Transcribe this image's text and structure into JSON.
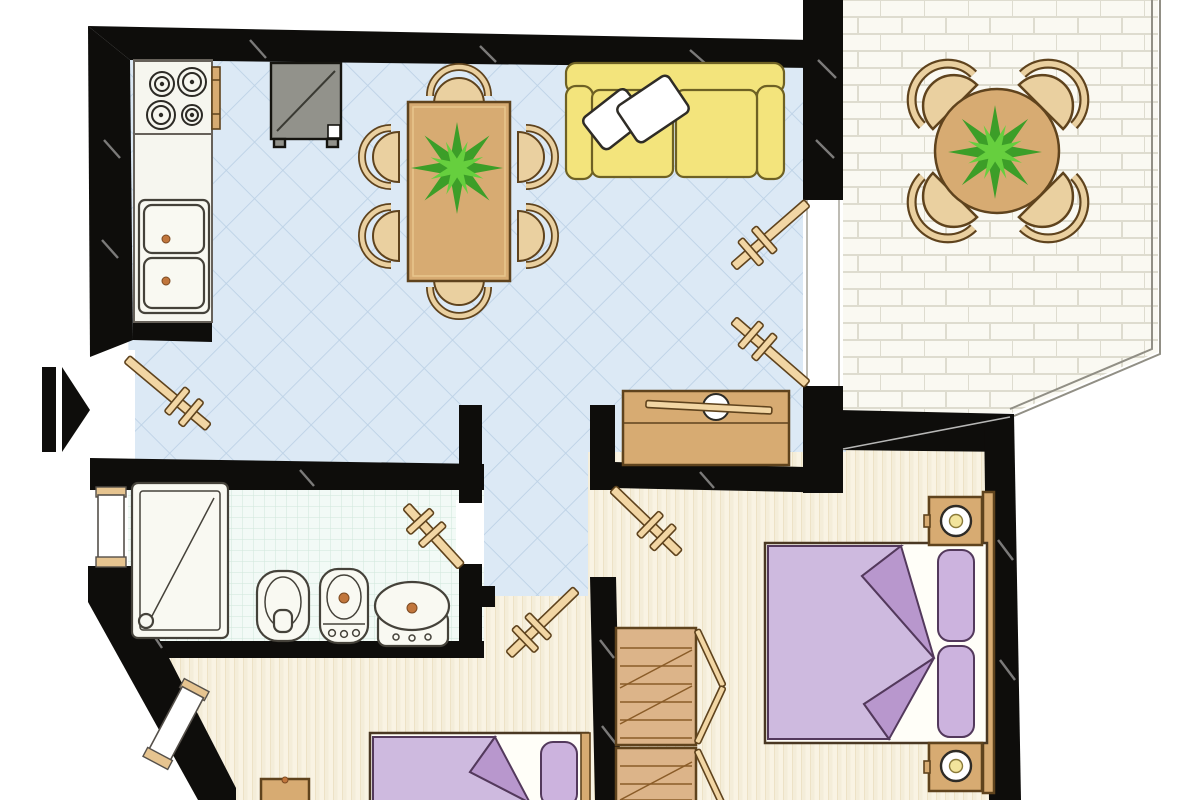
{
  "meta": {
    "title": "apartment-floor-plan",
    "canvas_width": 1200,
    "canvas_height": 800,
    "visible_text": "none"
  },
  "colors": {
    "wall": "#0e0d0b",
    "living_floor": "#dce9f5",
    "tile_line": "#bdd2e6",
    "bath_floor": "#f2faf6",
    "bath_grid": "#cfe7da",
    "wood_floor": "#f9f3e3",
    "wood_stripe": "#eadebe",
    "wood_shade": "#f4edd9",
    "balcony_floor": "#faf9f2",
    "brick_line": "#dedccf",
    "door_wood": "#f2d6a4",
    "wood_furniture": "#ead0a0",
    "wood_dark": "#d7ab72",
    "wood_border": "#5f431d",
    "sofa": "#f3e47c",
    "sofa_border": "#6e6124",
    "pillow_white": "#ffffff",
    "bed_blanket": "#cebadf",
    "bed_fold": "#b897cd",
    "bed_purple_border": "#53395c",
    "bed_pillow": "#ccb3de",
    "plant_dark": "#3c9e28",
    "plant_light": "#66cf3e",
    "appliance": "#92928b",
    "fixture": "#f9f9f2",
    "fixture_border": "#45423a",
    "accent_dot": "#c1763c",
    "arrow": "#0e0d0b",
    "lamp_core": "#f2e49c"
  },
  "rooms": [
    {
      "id": "living-dining",
      "floor": "blue-diagonal-tile",
      "furniture": [
        "dining-table",
        "plant",
        "six-chairs",
        "sofa",
        "two-white-cushions",
        "sideboard"
      ]
    },
    {
      "id": "kitchen",
      "floor": "blue-diagonal-tile",
      "furniture": [
        "stove-four-burners",
        "oven-handle",
        "counter",
        "double-sink",
        "appliance"
      ]
    },
    {
      "id": "balcony",
      "floor": "white-brick-paving",
      "furniture": [
        "round-table",
        "plant",
        "four-chairs"
      ]
    },
    {
      "id": "bathroom",
      "floor": "mint-grid-tile",
      "furniture": [
        "shower",
        "toilet",
        "bidet",
        "washbasin"
      ]
    },
    {
      "id": "hallway",
      "floor": "blue-diagonal-tile",
      "furniture": []
    },
    {
      "id": "bedroom-main",
      "floor": "wood-plank",
      "furniture": [
        "double-bed",
        "two-pillows",
        "headboard",
        "two-nightstands",
        "two-lamps",
        "wardrobe"
      ]
    },
    {
      "id": "bedroom-second",
      "floor": "wood-plank",
      "furniture": [
        "bed",
        "pillow",
        "headboard",
        "nightstand"
      ]
    }
  ],
  "doors": [
    {
      "id": "entry-door",
      "swing": "inward"
    },
    {
      "id": "bathroom-door",
      "swing": "into-bathroom"
    },
    {
      "id": "bedroom-main-door",
      "swing": "into-bedroom"
    },
    {
      "id": "bedroom-second-door",
      "swing": "into-bedroom"
    },
    {
      "id": "balcony-double-door-upper-leaf",
      "swing": "into-living-room"
    },
    {
      "id": "balcony-double-door-lower-leaf",
      "swing": "into-living-room"
    }
  ],
  "windows": [
    {
      "id": "bathroom-window"
    },
    {
      "id": "bedroom-second-window"
    }
  ],
  "entry_arrow": {
    "direction": "right"
  }
}
